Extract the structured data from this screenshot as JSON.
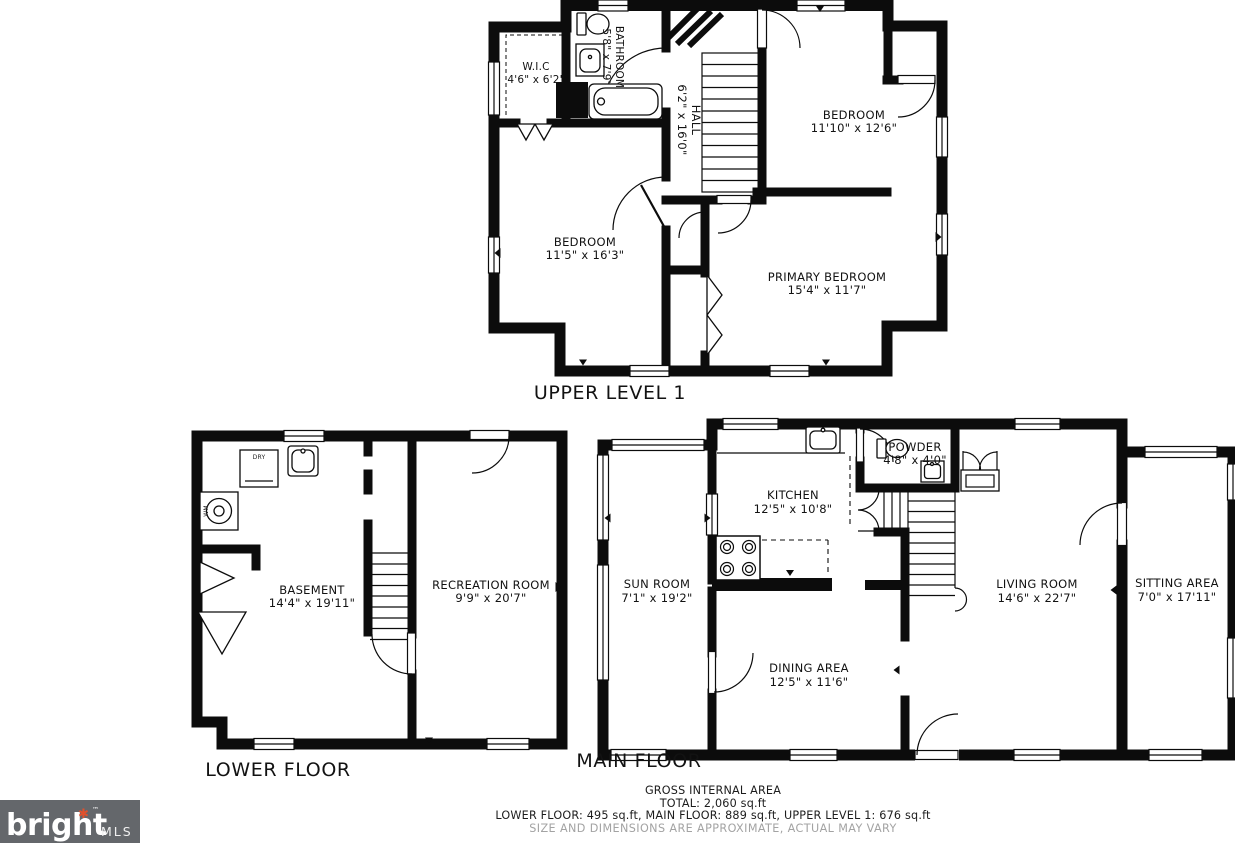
{
  "floors": {
    "upper": {
      "title": "UPPER LEVEL 1",
      "rooms": {
        "wic": {
          "name": "W.I.C",
          "dims": "4'6\" x 6'2\""
        },
        "bathroom": {
          "name": "BATHROOM",
          "dims": "5'8\" x 7'9\""
        },
        "hall": {
          "name": "HALL",
          "dims": "6'2\" x 16'0\""
        },
        "bedroom1": {
          "name": "BEDROOM",
          "dims": "11'10\" x 12'6\""
        },
        "bedroom2": {
          "name": "BEDROOM",
          "dims": "11'5\" x 16'3\""
        },
        "primary": {
          "name": "PRIMARY BEDROOM",
          "dims": "15'4\" x 11'7\""
        }
      }
    },
    "lower": {
      "title": "LOWER FLOOR",
      "rooms": {
        "basement": {
          "name": "BASEMENT",
          "dims": "14'4\" x 19'11\""
        },
        "recreation": {
          "name": "RECREATION ROOM",
          "dims": "9'9\" x 20'7\""
        }
      },
      "appliances": {
        "dryer": "DRY",
        "washer": "WM"
      }
    },
    "main": {
      "title": "MAIN FLOOR",
      "rooms": {
        "kitchen": {
          "name": "KITCHEN",
          "dims": "12'5\" x 10'8\""
        },
        "powder": {
          "name": "POWDER",
          "dims": "4'8\" x 4'0\""
        },
        "sunroom": {
          "name": "SUN ROOM",
          "dims": "7'1\" x 19'2\""
        },
        "dining": {
          "name": "DINING AREA",
          "dims": "12'5\" x 11'6\""
        },
        "living": {
          "name": "LIVING ROOM",
          "dims": "14'6\" x 22'7\""
        },
        "sitting": {
          "name": "SITTING AREA",
          "dims": "7'0\" x 17'11\""
        }
      }
    }
  },
  "footer": {
    "line1": "GROSS INTERNAL AREA",
    "line2": "TOTAL: 2,060 sq.ft",
    "line3": "LOWER FLOOR: 495 sq.ft, MAIN FLOOR: 889 sq.ft, UPPER LEVEL 1: 676 sq.ft",
    "disclaimer": "SIZE AND DIMENSIONS ARE APPROXIMATE, ACTUAL MAY VARY"
  },
  "logo": {
    "brand": "bright",
    "sub": "MLS",
    "tm": "™",
    "star": "✱"
  },
  "colors": {
    "wall": "#0c0c0c",
    "disclaimer_text": "#a3a3a3",
    "logo_bg": "#64676b",
    "logo_star": "#e0512c"
  }
}
